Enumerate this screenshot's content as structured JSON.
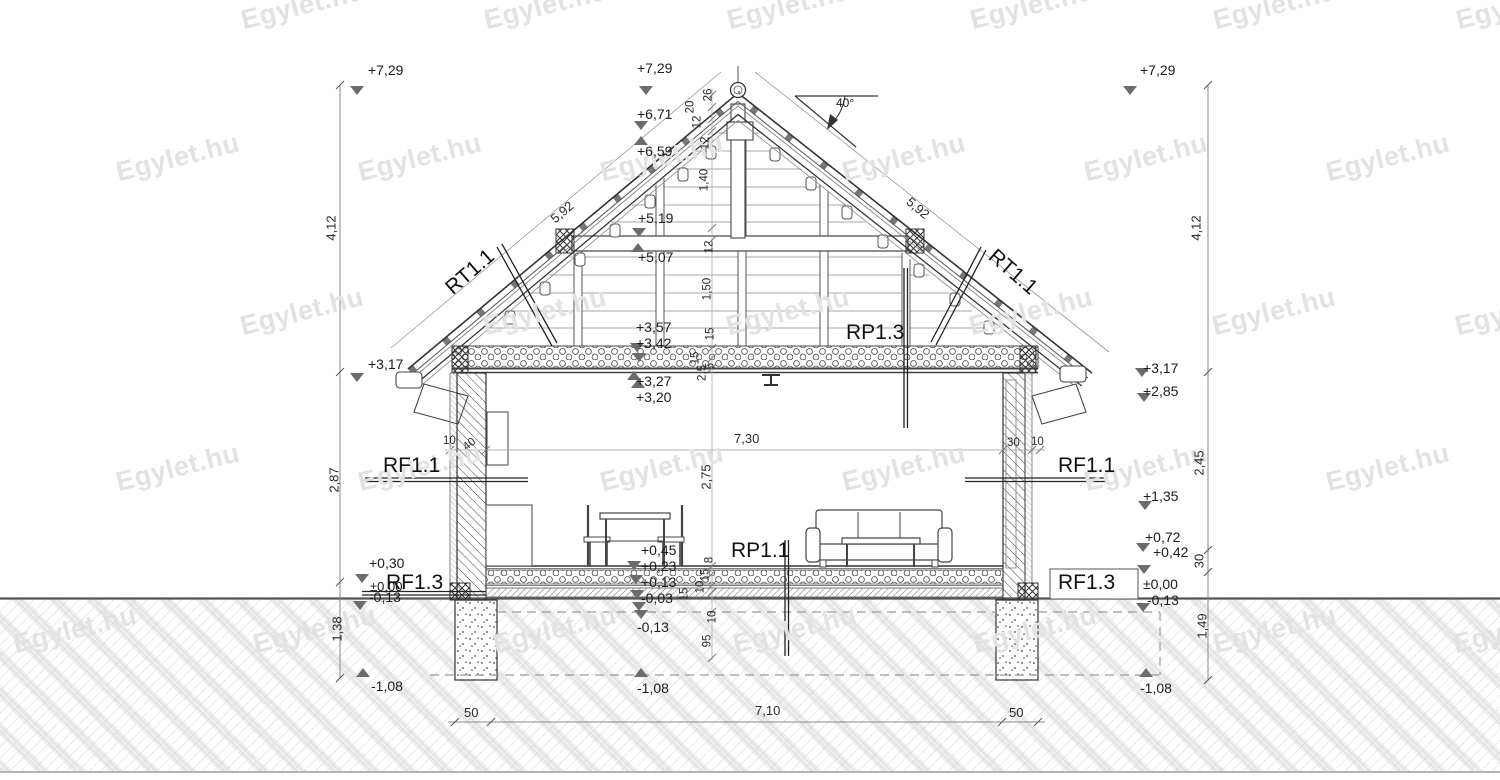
{
  "watermark": "Egylet.hu",
  "labels": {
    "rt11": "RT1.1",
    "rp13": "RP1.3",
    "rf11": "RF1.1",
    "rp11": "RP1.1",
    "rf13": "RF1.3",
    "roof_angle": "40°"
  },
  "levels_left": [
    "+7,29",
    "+3,17",
    "+0,30",
    "±0,00",
    "-0,13",
    "-1,08"
  ],
  "levels_center": [
    "+7,29",
    "+6,71",
    "+6,59",
    "+5,19",
    "+5,07",
    "+3,57",
    "+3,42",
    "+3,27",
    "+3,20",
    "+0,45",
    "+0,23",
    "+0,13",
    "-0,03",
    "-0,13",
    "-1,08"
  ],
  "levels_right": [
    "+7,29",
    "+3,17",
    "+2,85",
    "+1,35",
    "+0,72",
    "+0,42",
    "±0,00",
    "-0,13",
    "-1,08"
  ],
  "dims": {
    "left_chain": [
      "4,12",
      "2,87",
      "1,38"
    ],
    "right_chain": [
      "4,12",
      "2,45",
      "30",
      "1,49"
    ],
    "roof_slope_left": "5,92",
    "roof_slope_right": "5,92",
    "ridge_chain": [
      "26",
      "20",
      "12",
      "12",
      "1,40",
      "12",
      "1,50",
      "15",
      "15",
      "2,5",
      "5"
    ],
    "floor_chain": [
      "8",
      "15",
      "10",
      "15",
      "10",
      "95"
    ],
    "room_width": "7,30",
    "room_height": "2,75",
    "wall_left": [
      "10",
      "40"
    ],
    "wall_right": [
      "30",
      "10"
    ],
    "bottom_chain": [
      "50",
      "7,10",
      "50"
    ]
  }
}
